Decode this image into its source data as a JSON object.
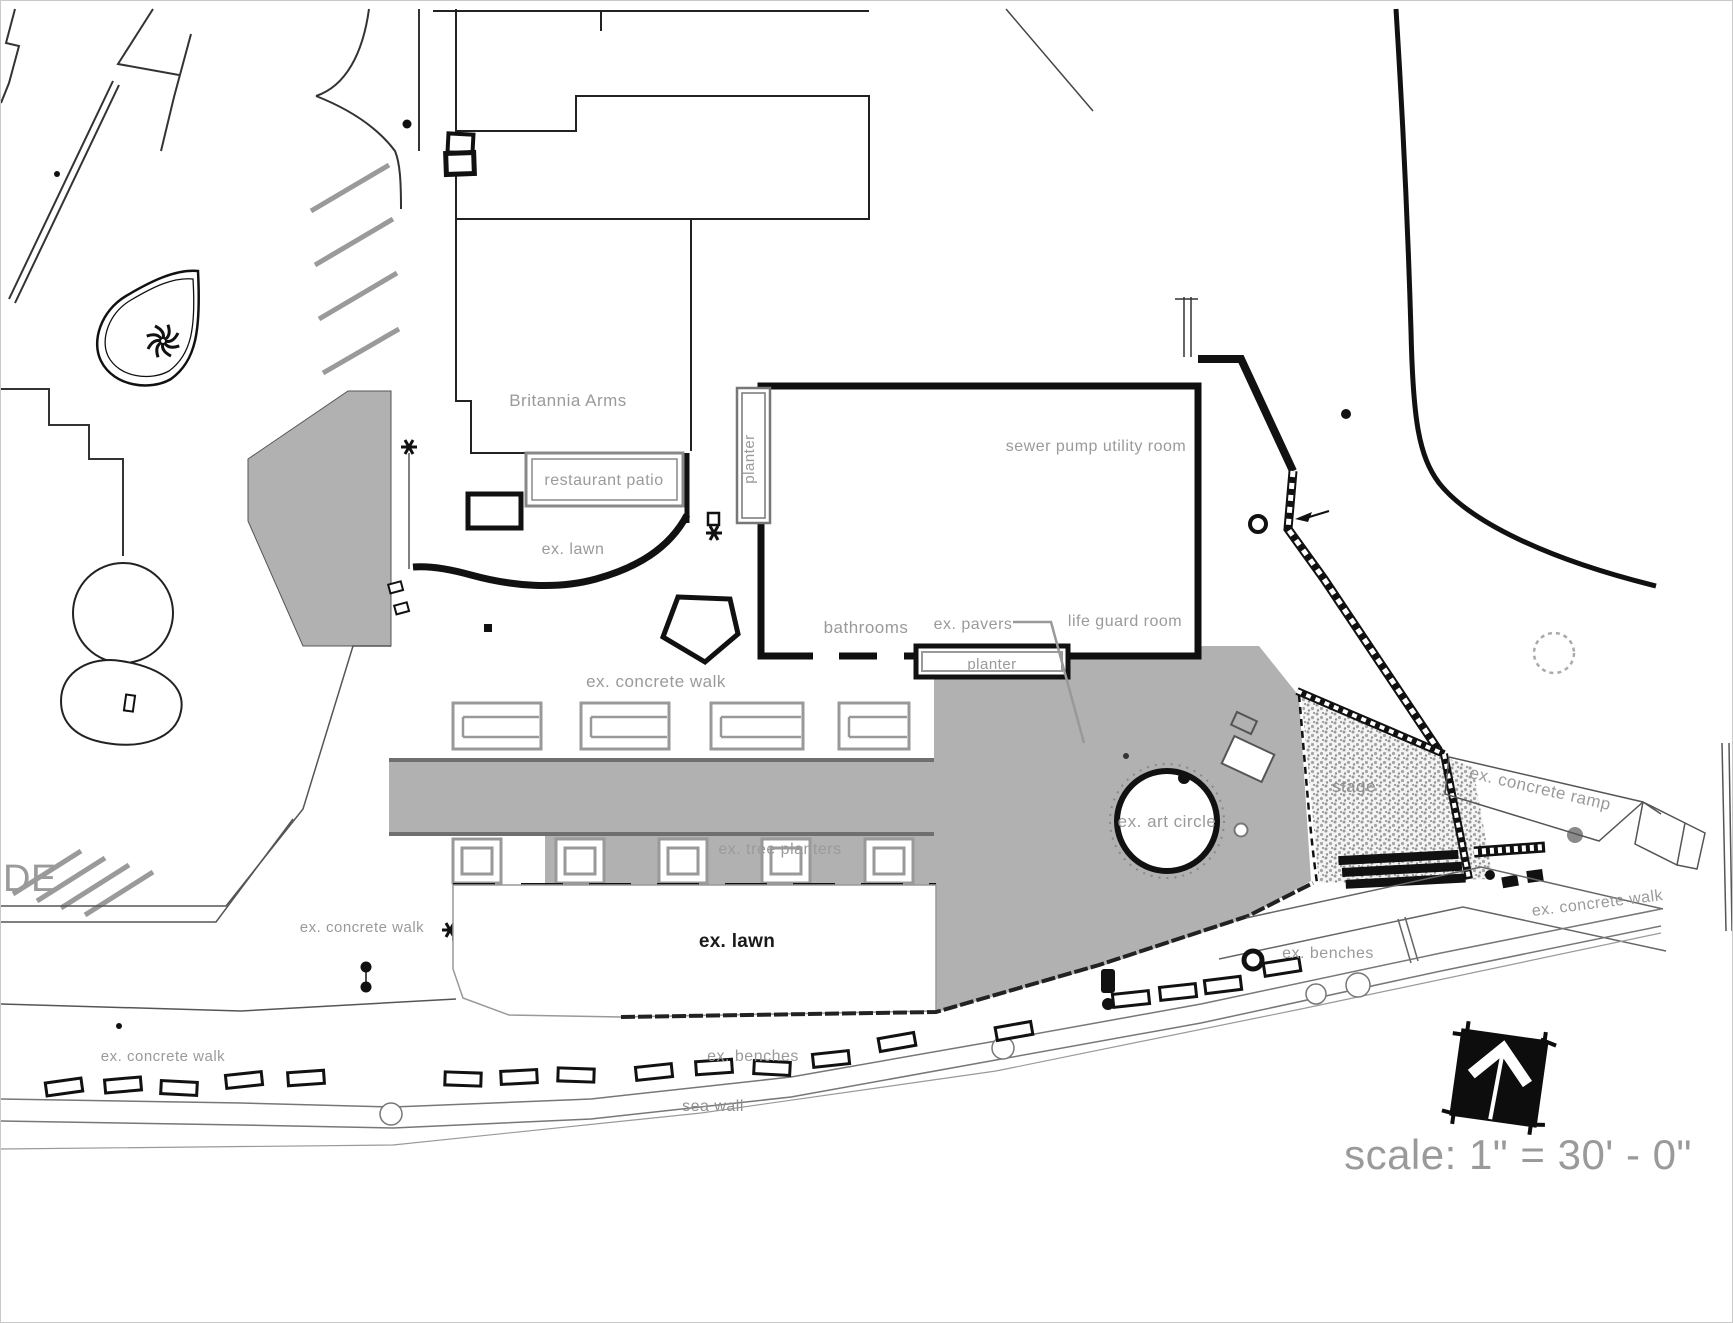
{
  "drawing": {
    "type": "architectural site plan",
    "buildings": {
      "britannia_arms": "Britannia Arms",
      "restaurant_patio": "restaurant patio",
      "sewer_pump_utility_room": "sewer pump utility room",
      "bathrooms": "bathrooms",
      "life_guard_room": "life guard room"
    },
    "site_labels": {
      "planter_west": "planter",
      "planter_south": "planter",
      "ex_pavers": "ex. pavers",
      "ex_lawn_north": "ex. lawn",
      "ex_lawn_south": "ex. lawn",
      "ex_concrete_walk_center": "ex. concrete walk",
      "ex_concrete_walk_west": "ex. concrete walk",
      "ex_concrete_walk_southwest": "ex. concrete walk",
      "ex_concrete_walk_east": "ex. concrete walk",
      "ex_concrete_ramp": "ex. concrete ramp",
      "ex_tree_planters": "ex. tree planters",
      "ex_art_circle": "ex. art circle",
      "stage": "stage",
      "ex_benches_south": "ex. benches",
      "ex_benches_east": "ex. benches",
      "sea_wall": "sea wall",
      "edge_text": "DE"
    },
    "scale_note": "scale: 1\" = 30' - 0\"",
    "north_arrow_icon": "north-arrow",
    "colors": {
      "paving_gray": "#b1b1b1",
      "label_gray": "#9a9a9a",
      "line_black": "#111111"
    }
  }
}
